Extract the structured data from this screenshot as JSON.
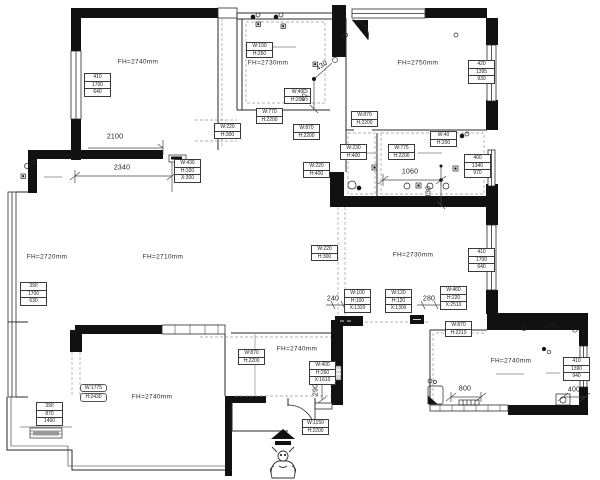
{
  "drawing": {
    "accent_wall_color": "#111111",
    "dashed_line_color": "#999999",
    "thin_wall_color": "#2a2a2a"
  },
  "rooms": [
    {
      "id": "bedroom-top-left",
      "label": "FH=2740mm",
      "x": 138,
      "y": 62
    },
    {
      "id": "balcony-top-middle",
      "label": "FH=2730mm",
      "x": 268,
      "y": 63
    },
    {
      "id": "bedroom-top-right",
      "label": "FH=2750mm",
      "x": 418,
      "y": 63
    },
    {
      "id": "living-room",
      "label": "FH=2720mm",
      "x": 47,
      "y": 257
    },
    {
      "id": "dining-hall",
      "label": "FH=2710mm",
      "x": 163,
      "y": 257
    },
    {
      "id": "bedroom-right",
      "label": "FH=2730mm",
      "x": 413,
      "y": 255
    },
    {
      "id": "bedroom-bottom-left",
      "label": "FH=2740mm",
      "x": 152,
      "y": 397
    },
    {
      "id": "entry-hall",
      "label": "FH=2740mm",
      "x": 297,
      "y": 349
    },
    {
      "id": "kitchen",
      "label": "FH=2740mm",
      "x": 511,
      "y": 361
    }
  ],
  "spec_boxes": [
    {
      "x": 84,
      "y": 74,
      "rows": [
        "410",
        "1700",
        "640"
      ]
    },
    {
      "x": 246,
      "y": 43,
      "rows": [
        "W:100",
        "H:260"
      ]
    },
    {
      "x": 284,
      "y": 89,
      "rows": [
        "W:40",
        "H:200"
      ]
    },
    {
      "x": 256,
      "y": 109,
      "rows": [
        "W:770",
        "H:2200"
      ]
    },
    {
      "x": 293,
      "y": 125,
      "rows": [
        "W:870",
        "H:2200"
      ]
    },
    {
      "x": 214,
      "y": 124,
      "rows": [
        "W:220",
        "H:300"
      ]
    },
    {
      "x": 468,
      "y": 61,
      "rows": [
        "420",
        "1395",
        "930"
      ]
    },
    {
      "x": 351,
      "y": 112,
      "rows": [
        "W:870",
        "H:2200"
      ]
    },
    {
      "x": 430,
      "y": 132,
      "rows": [
        "W:40",
        "H:200"
      ]
    },
    {
      "x": 340,
      "y": 145,
      "rows": [
        "W:230",
        "H:400"
      ]
    },
    {
      "x": 388,
      "y": 145,
      "rows": [
        "W:775",
        "H:2200"
      ]
    },
    {
      "x": 464,
      "y": 155,
      "rows": [
        "400",
        "1340",
        "970"
      ]
    },
    {
      "x": 174,
      "y": 160,
      "rows": [
        "W:430",
        "H:320",
        "X:300"
      ]
    },
    {
      "x": 303,
      "y": 163,
      "rows": [
        "W:220",
        "H:400"
      ]
    },
    {
      "x": 20,
      "y": 283,
      "rows": [
        "390",
        "1700",
        "630"
      ]
    },
    {
      "x": 311,
      "y": 246,
      "rows": [
        "W:220",
        "H:300"
      ]
    },
    {
      "x": 468,
      "y": 249,
      "rows": [
        "410",
        "1700",
        "640"
      ]
    },
    {
      "x": 440,
      "y": 287,
      "rows": [
        "W:460",
        "H:220",
        "X:2510"
      ]
    },
    {
      "x": 344,
      "y": 290,
      "rows": [
        "W:100",
        "H:100",
        "X:1320"
      ]
    },
    {
      "x": 385,
      "y": 290,
      "rows": [
        "W:120",
        "H:120",
        "X:1300"
      ]
    },
    {
      "x": 445,
      "y": 322,
      "rows": [
        "W:870",
        "H:2210"
      ]
    },
    {
      "x": 563,
      "y": 358,
      "rows": [
        "410",
        "1390",
        "940"
      ]
    },
    {
      "x": 80,
      "y": 383,
      "rows": [
        "W:1775",
        "H:2430"
      ],
      "style": "rounded"
    },
    {
      "x": 36,
      "y": 403,
      "rows": [
        "390",
        "870",
        "1460"
      ]
    },
    {
      "x": 238,
      "y": 350,
      "rows": [
        "W:870",
        "H:2200"
      ]
    },
    {
      "x": 309,
      "y": 362,
      "rows": [
        "W:400",
        "H:260",
        "X:1610"
      ]
    },
    {
      "x": 302,
      "y": 420,
      "rows": [
        "W:1150",
        "H:2200"
      ]
    }
  ],
  "dimensions": [
    {
      "text": "2100",
      "x": 115,
      "y": 137
    },
    {
      "text": "2340",
      "x": 122,
      "y": 168
    },
    {
      "text": "430",
      "x": 322,
      "y": 66,
      "rot": -35
    },
    {
      "text": "570",
      "x": 306,
      "y": 95,
      "rot": -90
    },
    {
      "text": "1060",
      "x": 410,
      "y": 172
    },
    {
      "text": "430",
      "x": 429,
      "y": 192,
      "rot": -90
    },
    {
      "text": "240",
      "x": 333,
      "y": 299
    },
    {
      "text": "280",
      "x": 429,
      "y": 299
    },
    {
      "text": "290",
      "x": 316,
      "y": 390,
      "rot": -90
    },
    {
      "text": "800",
      "x": 465,
      "y": 389
    },
    {
      "text": "400",
      "x": 574,
      "y": 390
    }
  ]
}
